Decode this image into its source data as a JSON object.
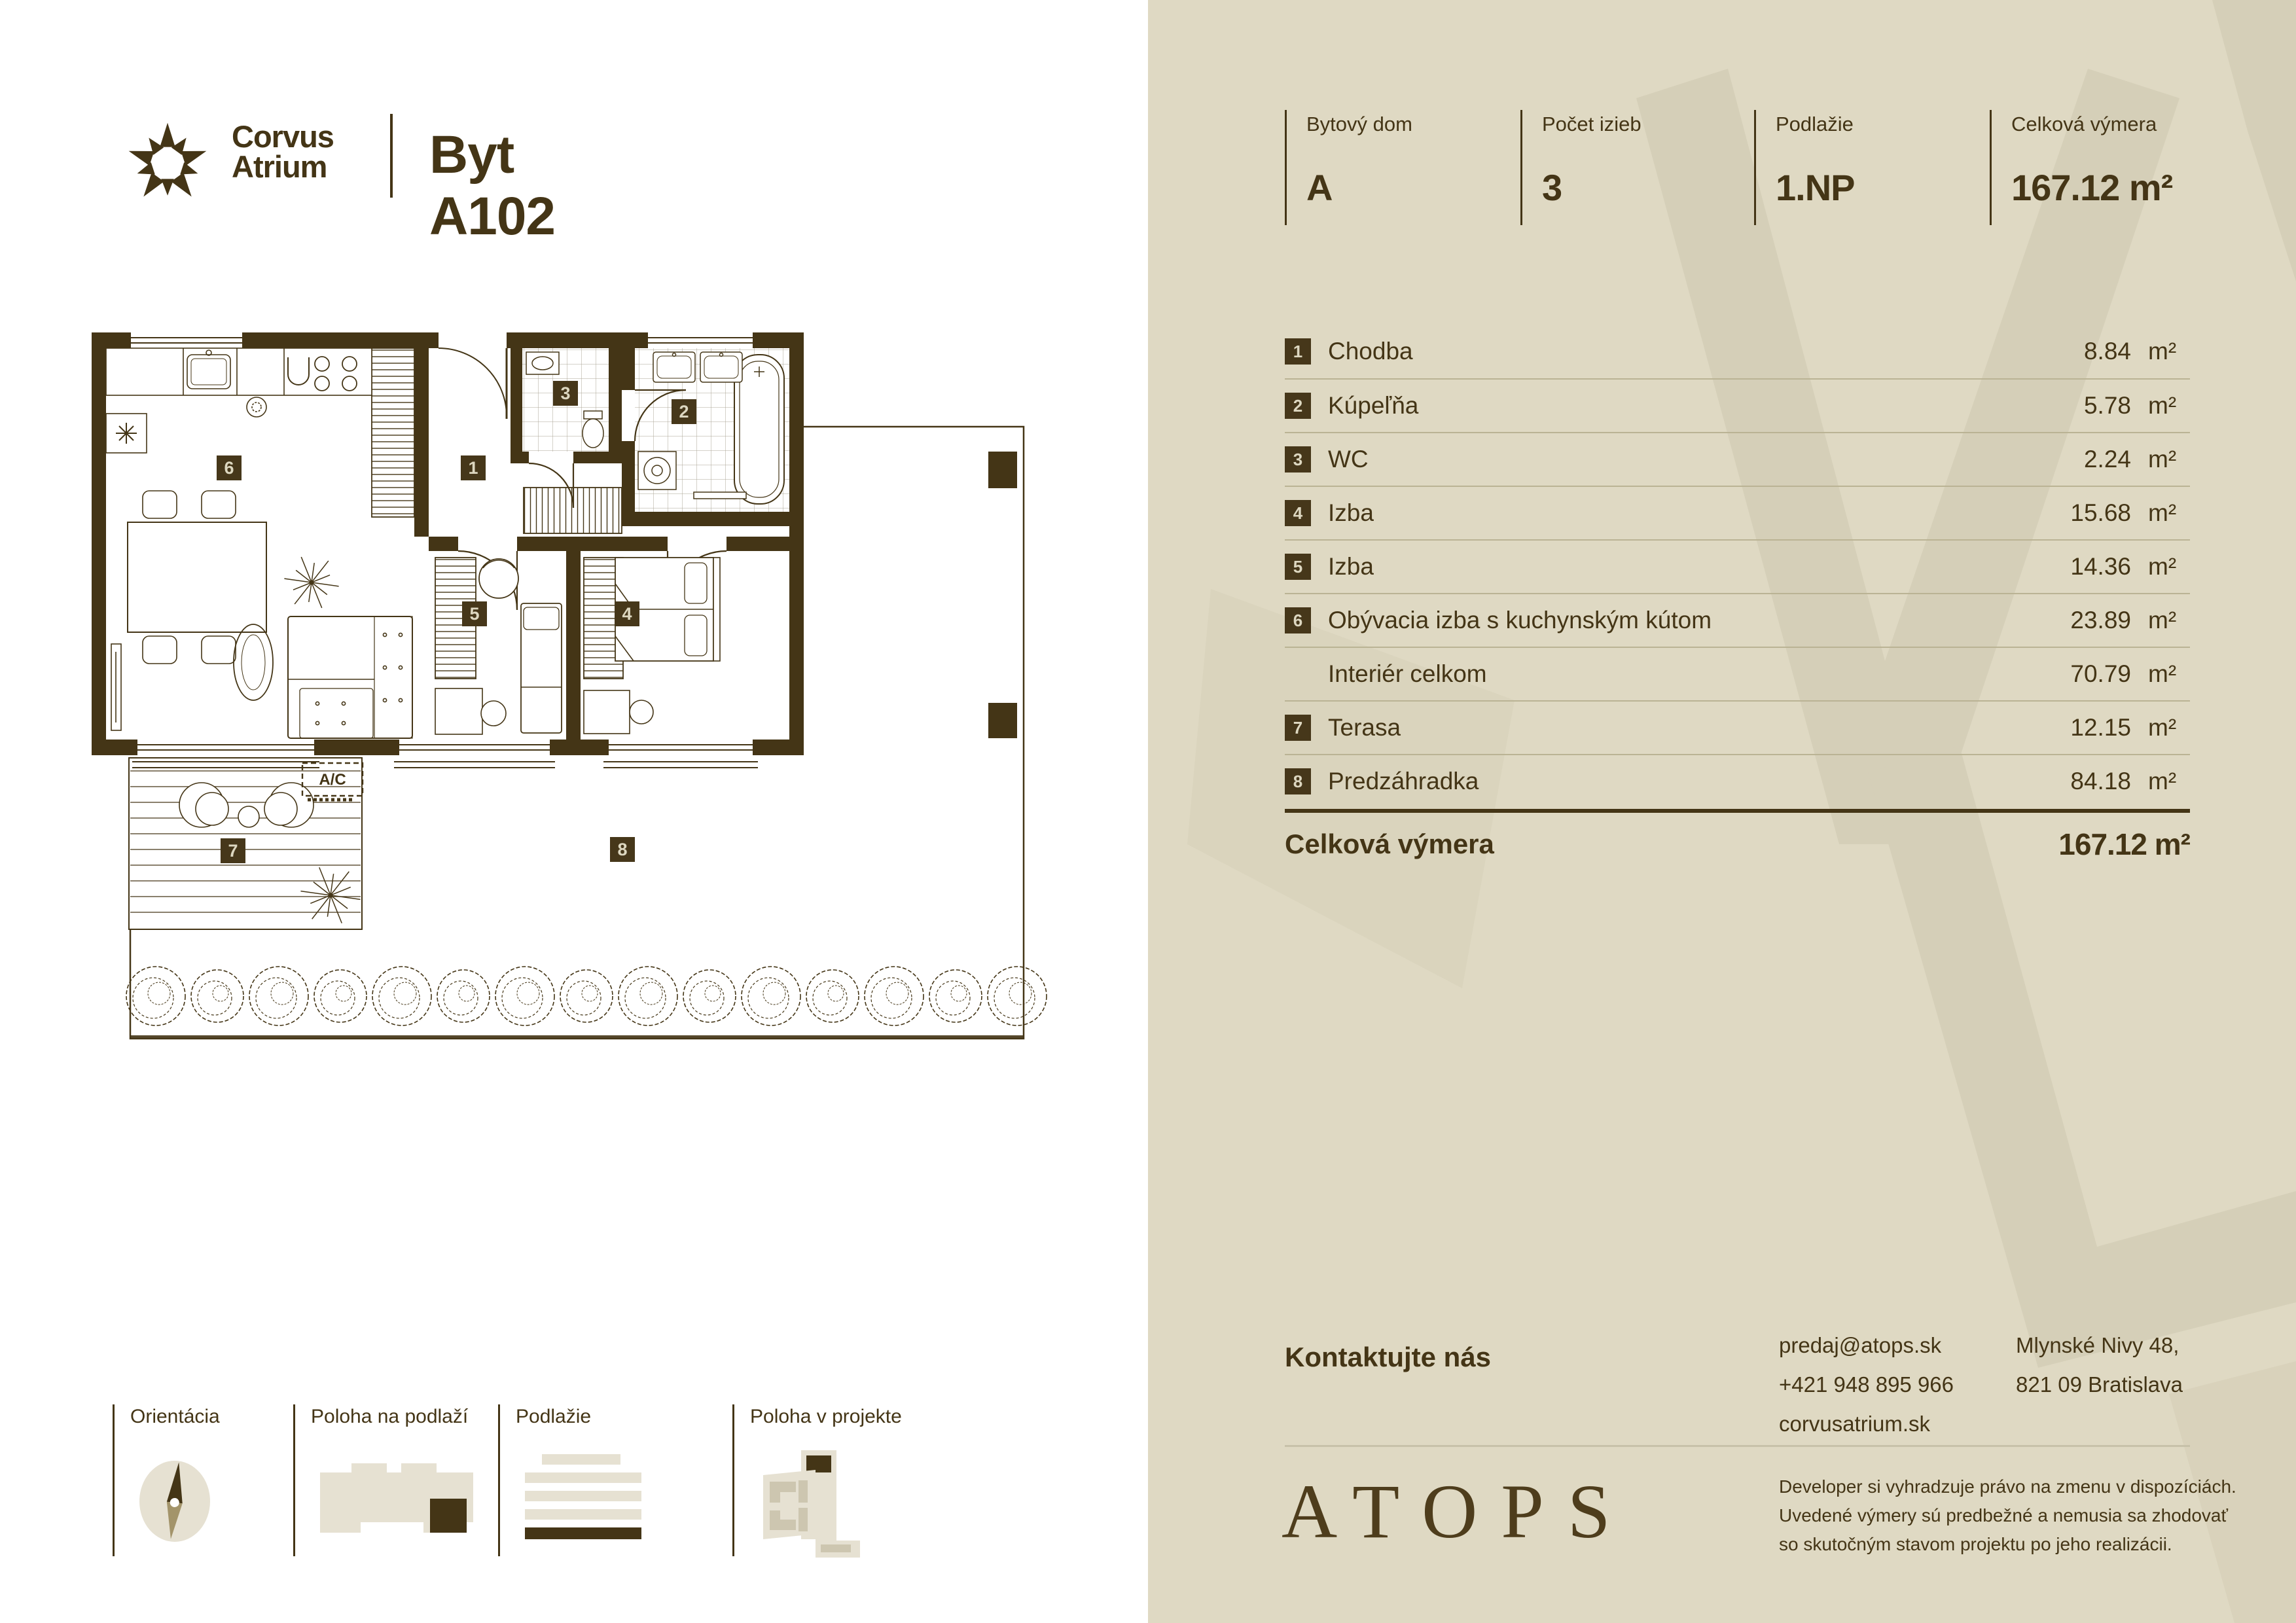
{
  "brand": {
    "name_line1": "Corvus",
    "name_line2": "Atrium",
    "unit_title": "Byt A102"
  },
  "stats": [
    {
      "label": "Bytový dom",
      "value": "A"
    },
    {
      "label": "Počet izieb",
      "value": "3"
    },
    {
      "label": "Podlažie",
      "value": "1.NP"
    },
    {
      "label": "Celková výmera",
      "value": "167.12 m²"
    }
  ],
  "area_table": {
    "rows": [
      {
        "num": "1",
        "name": "Chodba",
        "value": "8.84",
        "unit": "m²"
      },
      {
        "num": "2",
        "name": "Kúpeľňa",
        "value": "5.78",
        "unit": "m²"
      },
      {
        "num": "3",
        "name": "WC",
        "value": "2.24",
        "unit": "m²"
      },
      {
        "num": "4",
        "name": "Izba",
        "value": "15.68",
        "unit": "m²"
      },
      {
        "num": "5",
        "name": "Izba",
        "value": "14.36",
        "unit": "m²"
      },
      {
        "num": "6",
        "name": "Obývacia izba s kuchynským kútom",
        "value": "23.89",
        "unit": "m²"
      },
      {
        "num": "",
        "name": "Interiér celkom",
        "value": "70.79",
        "unit": "m²"
      },
      {
        "num": "7",
        "name": "Terasa",
        "value": "12.15",
        "unit": "m²"
      },
      {
        "num": "8",
        "name": "Predzáhradka",
        "value": "84.18",
        "unit": "m²"
      }
    ],
    "total_label": "Celková výmera",
    "total_value": "167.12 m²"
  },
  "contact": {
    "heading": "Kontaktujte nás",
    "email": "predaj@atops.sk",
    "phone": "+421 948 895 966",
    "website": "corvusatrium.sk",
    "address_line1": "Mlynské Nivy 48,",
    "address_line2": "821 09 Bratislava"
  },
  "developer": {
    "logo": "ATOPS",
    "disclaimer_line1": "Developer si vyhradzuje právo na zmenu v dispozíciách.",
    "disclaimer_line2": "Uvedené výmery sú predbežné a nemusia sa zhodovať",
    "disclaimer_line3": "so skutočným stavom projektu po jeho realizácii."
  },
  "footer_legend": [
    {
      "label": "Orientácia",
      "icon": "compass-icon"
    },
    {
      "label": "Poloha na podlaží",
      "icon": "floor-position-icon"
    },
    {
      "label": "Podlažie",
      "icon": "floor-level-icon"
    },
    {
      "label": "Poloha v projekte",
      "icon": "project-position-icon"
    }
  ],
  "floorplan": {
    "room_labels": [
      "1",
      "2",
      "3",
      "4",
      "5",
      "6",
      "7",
      "8"
    ],
    "ac_label": "A/C"
  },
  "colors": {
    "ink": "#443516",
    "panel_background": "#dfd9c3",
    "watermark": "#d5cfb8",
    "badge": "#46371a",
    "badge_text": "#ddd7c0",
    "row_divider": "#bab394"
  }
}
